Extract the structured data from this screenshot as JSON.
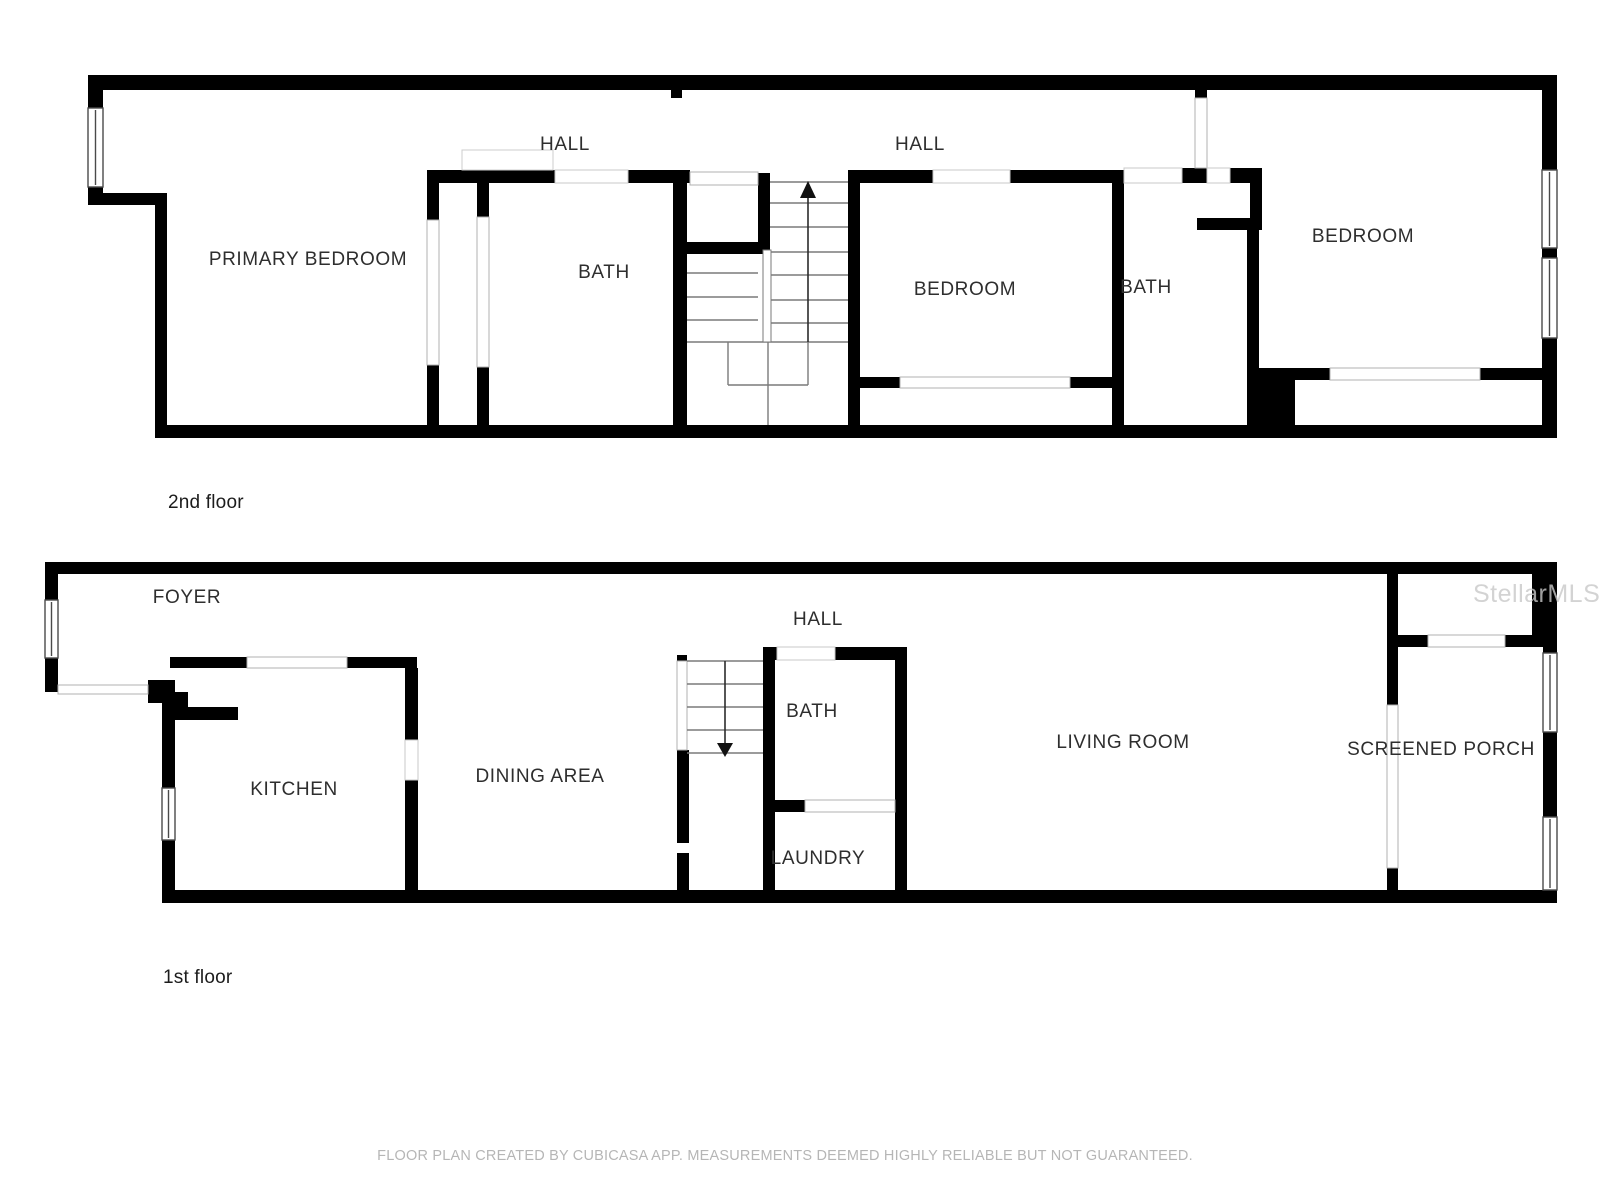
{
  "floors": [
    {
      "title": "2nd floor",
      "rooms": [
        {
          "label": "PRIMARY BEDROOM"
        },
        {
          "label": "HALL"
        },
        {
          "label": "BATH"
        },
        {
          "label": "HALL"
        },
        {
          "label": "BEDROOM"
        },
        {
          "label": "BATH"
        },
        {
          "label": "BEDROOM"
        }
      ]
    },
    {
      "title": "1st floor",
      "rooms": [
        {
          "label": "FOYER"
        },
        {
          "label": "KITCHEN"
        },
        {
          "label": "DINING AREA"
        },
        {
          "label": "HALL"
        },
        {
          "label": "BATH"
        },
        {
          "label": "LAUNDRY"
        },
        {
          "label": "LIVING ROOM"
        },
        {
          "label": "SCREENED PORCH"
        }
      ]
    }
  ],
  "watermark": "StellarMLS",
  "disclaimer": "FLOOR PLAN CREATED BY CUBICASA APP. MEASUREMENTS DEEMED HIGHLY RELIABLE BUT NOT GUARANTEED.",
  "colors": {
    "wall": "#000000",
    "label": "#2e2e2e",
    "tread_line": "#7a7a7a",
    "opening_line": "#b0b0b0",
    "watermark": "#c9c9c9",
    "disclaimer": "#b6b6b6",
    "background": "#ffffff"
  }
}
